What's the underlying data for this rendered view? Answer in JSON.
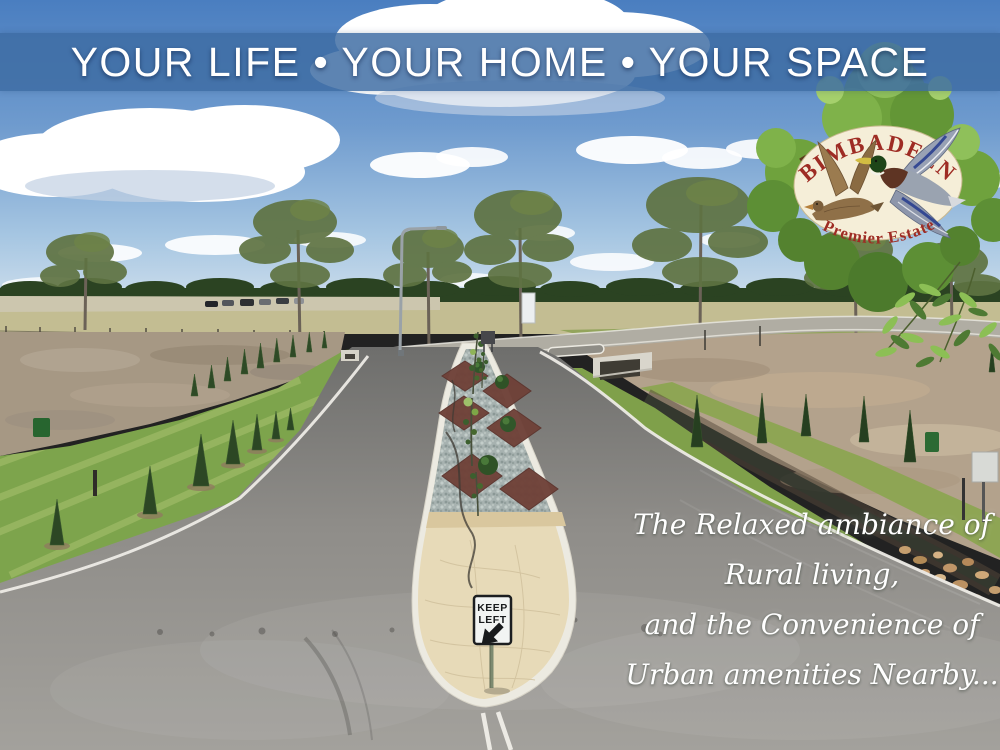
{
  "banner": {
    "text": "YOUR LIFE • YOUR HOME • YOUR SPACE"
  },
  "logo": {
    "name": "BIMBADEEN",
    "tagline": "Premier Estate"
  },
  "road_sign": {
    "line1": "KEEP",
    "line2": "LEFT",
    "arrow_icon": "down-left-arrow"
  },
  "quote": {
    "line1": "The Relaxed ambiance of",
    "line2": "Rural living,",
    "line3": "and the Convenience of",
    "line4": "Urban amenities Nearby..."
  },
  "colors": {
    "banner_bg": "#3e6da3",
    "banner_text": "#ffffff",
    "sky_top": "#4a7ec0",
    "sky_horizon": "#d4e2ee",
    "logo_text_red": "#9e2c24",
    "logo_oval_cream": "#f5eed8",
    "logo_foliage_green": "#6fa23d",
    "grass_green": "#7da44c",
    "dirt_tan": "#a69884",
    "asphalt_gray": "#8f8d89",
    "median_gravel_gray": "#a7b2b0",
    "mulch_red_brown": "#6f4138",
    "median_pavement_cream": "#e7dab8",
    "curb_white": "#eceae1",
    "sign_black": "#191b1d",
    "sign_white": "#f2f4f3",
    "drake_head_green": "#1d4518",
    "hen_brown": "#8f7048"
  }
}
